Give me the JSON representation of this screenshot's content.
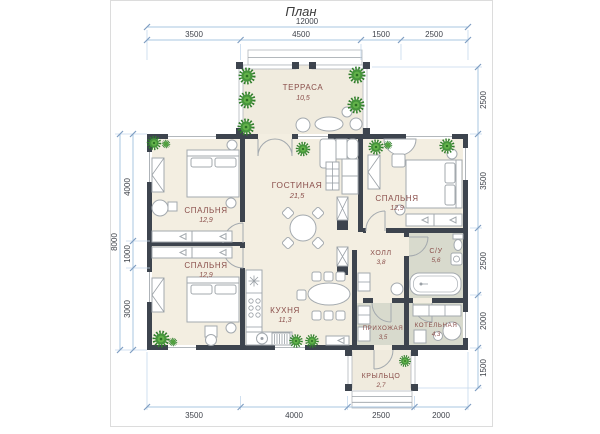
{
  "title": "План",
  "rooms": [
    {
      "id": "terrace",
      "name": "ТЕРРАСА",
      "area": "10,5"
    },
    {
      "id": "living",
      "name": "ГОСТИНАЯ",
      "area": "21,5"
    },
    {
      "id": "bedroom1",
      "name": "СПАЛЬНЯ",
      "area": "12,9"
    },
    {
      "id": "bedroom2",
      "name": "СПАЛЬНЯ",
      "area": "12,9"
    },
    {
      "id": "bedroom3",
      "name": "СПАЛЬНЯ",
      "area": "12,9"
    },
    {
      "id": "kitchen",
      "name": "КУХНЯ",
      "area": "11,3"
    },
    {
      "id": "hall",
      "name": "ХОЛЛ",
      "area": "3,8"
    },
    {
      "id": "bathroom",
      "name": "С/У",
      "area": "5,6"
    },
    {
      "id": "entry",
      "name": "ПРИХОЖАЯ",
      "area": "3,5"
    },
    {
      "id": "boiler",
      "name": "КОТЕЛЬНАЯ",
      "area": "4,3"
    },
    {
      "id": "porch",
      "name": "КРЫЛЬЦО",
      "area": "2,7"
    }
  ],
  "dimensions": {
    "top_overall": "12000",
    "top": [
      "3500",
      "4500",
      "1500",
      "2500"
    ],
    "left_overall": "8000",
    "left": [
      "4000",
      "1000",
      "3000"
    ],
    "right": [
      "2500",
      "3500",
      "2500",
      "2000",
      "1500"
    ],
    "bottom": [
      "3500",
      "4000",
      "2500",
      "2000"
    ]
  },
  "colors": {
    "wall": "#3d444e",
    "floor": "#f3eee1",
    "wet_floor": "#d8dacd",
    "room_label": "#8a4f4b",
    "plant": "#46953c",
    "dimension_line": "#aac7e2",
    "dimension_text": "#3f434b"
  }
}
